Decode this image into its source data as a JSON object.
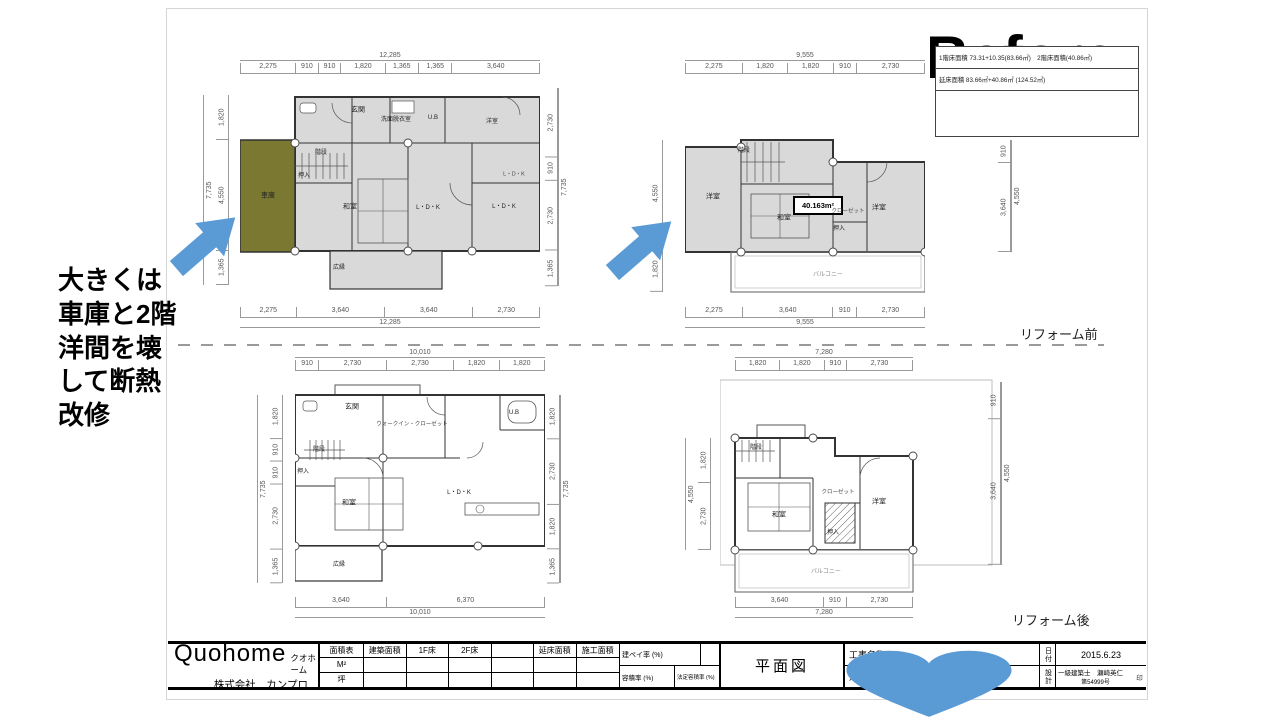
{
  "page": {
    "before_label": "Before",
    "reform_before": "リフォーム前",
    "reform_after": "リフォーム後"
  },
  "note": {
    "lines": [
      "大きくは",
      "車庫と2階",
      "洋間を壊",
      "して断熱",
      "改修"
    ]
  },
  "info_box": {
    "row1": "1階床面積 73.31+10.35(83.66㎡)　2階床面積(40.86㎡)",
    "row2": "延床面積 83.66㎡+40.86㎡ (124.52㎡)"
  },
  "plans": {
    "p1": {
      "top_total": "12,285",
      "top_segs": [
        "2,275",
        "910",
        "910",
        "1,820",
        "1,365",
        "1,365",
        "3,640"
      ],
      "bottom_segs": [
        "2,275",
        "3,640",
        "3,640",
        "2,730"
      ],
      "bottom_total": "12,285",
      "left_segs": [
        "1,820",
        "4,550",
        "1,365"
      ],
      "left_total": "7,735",
      "right_segs": [
        "2,730",
        "910",
        "2,730",
        "1,365"
      ],
      "right_total": "7,735",
      "rooms": {
        "entrance": "玄関",
        "washroom": "洗面脱衣室",
        "bath": "U.B",
        "bedroom": "洋室",
        "stairs": "階段",
        "closet": "押入",
        "washitsu": "和室",
        "ldk1": "L・D・K",
        "ldk2": "L・D・K",
        "ldk3": "L・D・K",
        "garage": "車庫",
        "veranda": "広縁"
      }
    },
    "p2": {
      "top_total": "9,555",
      "top_segs": [
        "2,275",
        "1,820",
        "1,820",
        "910",
        "2,730"
      ],
      "bottom_segs": [
        "2,275",
        "3,640",
        "910",
        "2,730"
      ],
      "bottom_total": "9,555",
      "left_segs": [
        "4,550",
        "1,820"
      ],
      "right_segs": [
        "910",
        "3,640"
      ],
      "right_total": "4,550",
      "area_callout": "40.163m²",
      "rooms": {
        "yoshitsu_l": "洋室",
        "stairs": "階段",
        "washitsu": "和室",
        "closet": "クローゼット",
        "oshiire": "押入",
        "yoshitsu_r": "洋室",
        "balcony": "バルコニー"
      }
    },
    "p3": {
      "top_total": "10,010",
      "top_segs": [
        "910",
        "2,730",
        "2,730",
        "1,820",
        "1,820"
      ],
      "bottom_segs": [
        "3,640",
        "6,370"
      ],
      "bottom_total": "10,010",
      "left_segs": [
        "1,820",
        "910",
        "910",
        "2,730",
        "1,365"
      ],
      "left_total": "7,735",
      "right_segs": [
        "1,820",
        "2,730",
        "1,820",
        "1,365"
      ],
      "right_total": "7,735",
      "rooms": {
        "entrance": "玄関",
        "stairs": "階段",
        "oshiire": "押入",
        "washitsu": "和室",
        "veranda": "広縁",
        "wic": "ウォークイン・クローゼット",
        "ldk": "L・D・K",
        "bath": "U.B"
      }
    },
    "p4": {
      "top_total": "7,280",
      "top_segs": [
        "1,820",
        "1,820",
        "910",
        "2,730"
      ],
      "bottom_segs": [
        "3,640",
        "910",
        "2,730"
      ],
      "bottom_total": "7,280",
      "left_segs": [
        "1,820",
        "2,730"
      ],
      "left_total": "4,550",
      "right_segs": [
        "910",
        "3,640"
      ],
      "right_total": "4,550",
      "rooms": {
        "stairs": "階段",
        "washitsu": "和室",
        "oshiire": "押入",
        "closet": "クローゼット",
        "yoshitsu": "洋室",
        "balcony": "バルコニー"
      }
    }
  },
  "title_block": {
    "company_name": "Quohome",
    "company_kana": "クオホーム",
    "company_sub": "株式会社　カンプロ",
    "area_table": {
      "headers": [
        "面積表",
        "建築面積",
        "1F床",
        "2F床",
        "",
        "延床面積",
        "施工面積"
      ],
      "m2_label": "M²",
      "tsubo_label": "坪"
    },
    "kenpei_label": "建ペイ率 (%)",
    "yoseki_label": "容積率 (%)",
    "hotei_label": "法定容積率 (%)",
    "drawing_title": "平面図",
    "project_label": "工事名称",
    "site_label": "建築場所",
    "date_label": "日付",
    "date_value": "2015.6.23",
    "design_label": "設計",
    "architect": "一級建築士　瀬崎英仁",
    "license": "第54999号",
    "seal": "印"
  },
  "colors": {
    "accent_blue": "#5b9bd5",
    "garage_olive": "#7a7831",
    "room_gray": "#d9d9d9"
  }
}
